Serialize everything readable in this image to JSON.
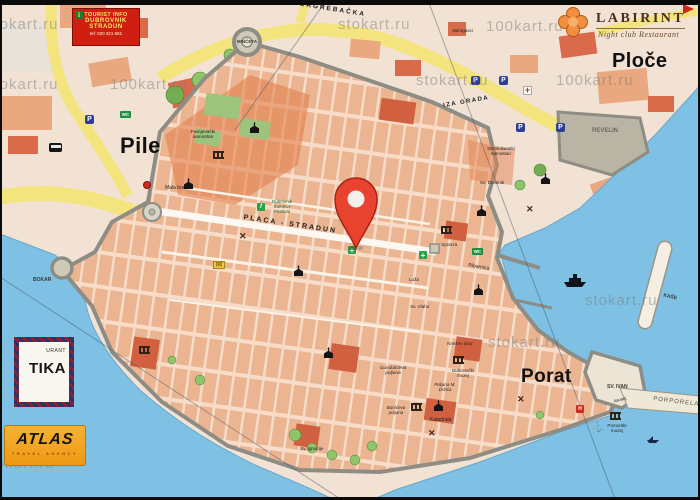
{
  "region_labels": {
    "pile": "Pile",
    "ploce": "Ploče",
    "porat": "Porat"
  },
  "street_labels": {
    "placa_stradun": "PLACA - STRADUN",
    "zagrebacka": "ZAGREBAČKA",
    "iza_grada": "IZA GRADA"
  },
  "fortification_labels": {
    "minceta": "MINČETA",
    "bokar": "BOKAR",
    "revelin": "REVELIN",
    "sv_ivan": "SV. IVAN",
    "kase": "KAŠE",
    "porporela": "PORPORELA"
  },
  "landmark_labels": {
    "vatrogasci": "Vatrogasci",
    "franjevacki_samostan": "Franjevački samostan",
    "mala_braca": "Mala braća",
    "dominikanski_samostan": "Dominikanski samostan",
    "sv_dominik": "Sv. Dominik",
    "festival": "Dubrovnik Summer Festival",
    "sponza": "Sponza",
    "luza": "Luža",
    "sv_vlaho": "Sv. Vlaho",
    "ribarnica": "Ribarnica",
    "knezev_dvor": "Knežev dvor",
    "dubrovacki_muzej": "Dubrovački muzej",
    "gunduliceva_poljana": "Gundulićeva poljana",
    "poljana_m_drzica": "Poljana M. Držića",
    "buniceva_poljana": "Bunićeva poljana",
    "katedrala": "Katedrala",
    "sv_ignacije": "Sv. Ignacije",
    "akvarij": "Akvarij",
    "pomorski_muzej": "Pomorski muzej"
  },
  "signs": {
    "tourist_info": {
      "icon_letter": "i",
      "line1": "TOURIST INFO",
      "line2": "DUBROVNIK",
      "line3": "STRADUN",
      "line4": "tel: 020 321 561"
    },
    "labirint": {
      "name": "LABIRINT",
      "tagline": "Night club Restaurant"
    },
    "atlas": {
      "name": "ATLAS",
      "tagline": "TRAVEL AGENCY"
    },
    "nautika": {
      "line1": "URANT",
      "line2": "TIKA"
    }
  },
  "watermarks": {
    "w1": "stokart.ru",
    "w2": "100kart.ru",
    "w3": "100kart.ru",
    "w4": "stokart.ru",
    "w5": "stokart.ru",
    "w6": "100kart.ru",
    "w7": "stokart.ru",
    "w8": "stokart.ru",
    "w9": "stokart.ru",
    "w10": "stokart.ru"
  },
  "icon_glyphs": {
    "parking": "P",
    "wc": "WC",
    "pharmacy_cross": "+",
    "red_cross": "+",
    "x_mark": "✕",
    "envelope": "✉",
    "anchor": "⚓",
    "festival": "f",
    "hotel": "H"
  },
  "colors": {
    "sea": "#7fc1e4",
    "land": "#f2e2d4",
    "old_town_blocks": "#ecb591",
    "accent_building": "#d0603f",
    "road_yellow": "#f3e47d",
    "park_green": "#7cb45c",
    "wall_gray": "#8d8d85",
    "pin_red": "#e8432e",
    "sign_red": "#d01f10",
    "atlas_orange": "#f2a723"
  }
}
